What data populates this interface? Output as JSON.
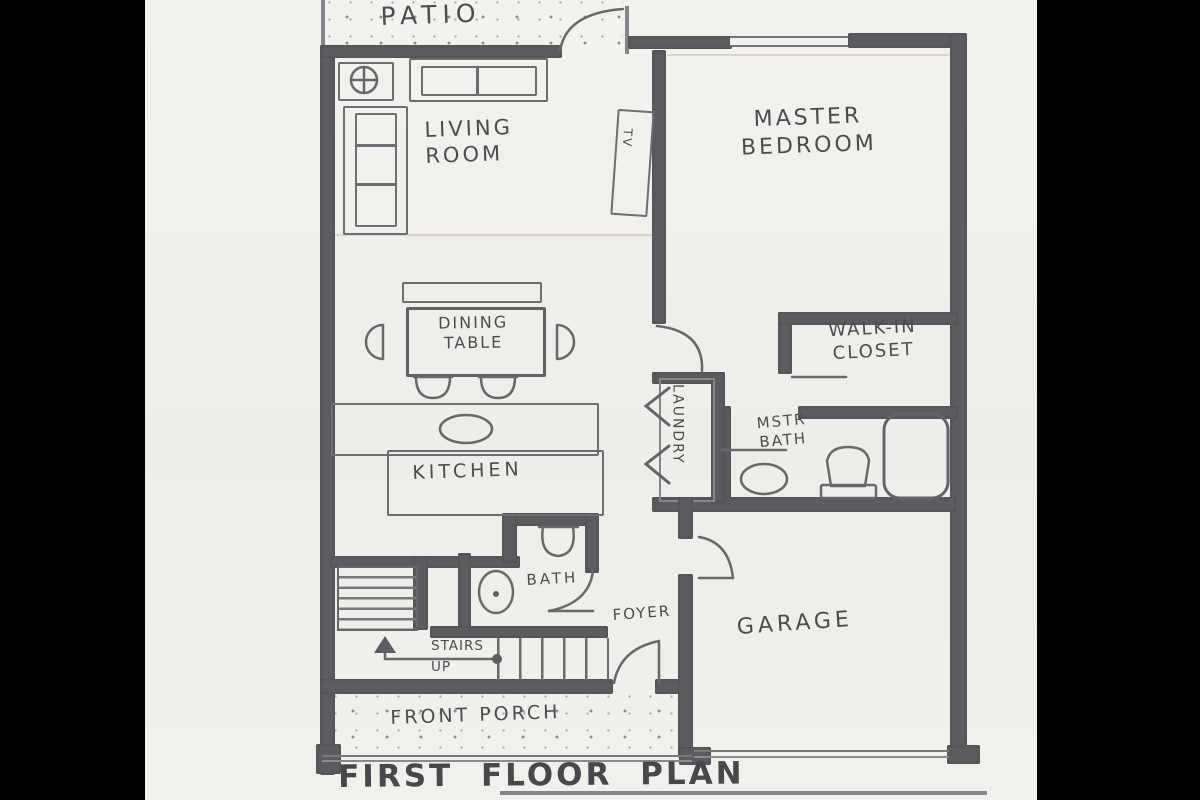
{
  "plan_title": "FIRST  FLOOR  PLAN",
  "rooms": {
    "patio": "PATIO",
    "living_room": "LIVING\nROOM",
    "master_bedroom": "MASTER\nBEDROOM",
    "dining_table": "DINING\nTABLE",
    "kitchen": "KITCHEN",
    "walk_in_closet": "WALK-IN\nCLOSET",
    "laundry": "LAUNDRY",
    "master_bath": "MSTR\nBATH",
    "bath": "BATH",
    "stairs": "STAIRS\nUP",
    "foyer": "FOYER",
    "garage": "GARAGE",
    "front_porch": "FRONT  PORCH",
    "tv": "TV"
  },
  "colors": {
    "paper": "#f2f0ec",
    "pencil_wall": "#5c5c60",
    "pencil_line": "#68686d",
    "text": "#4c4c50",
    "matte": "#010101"
  }
}
